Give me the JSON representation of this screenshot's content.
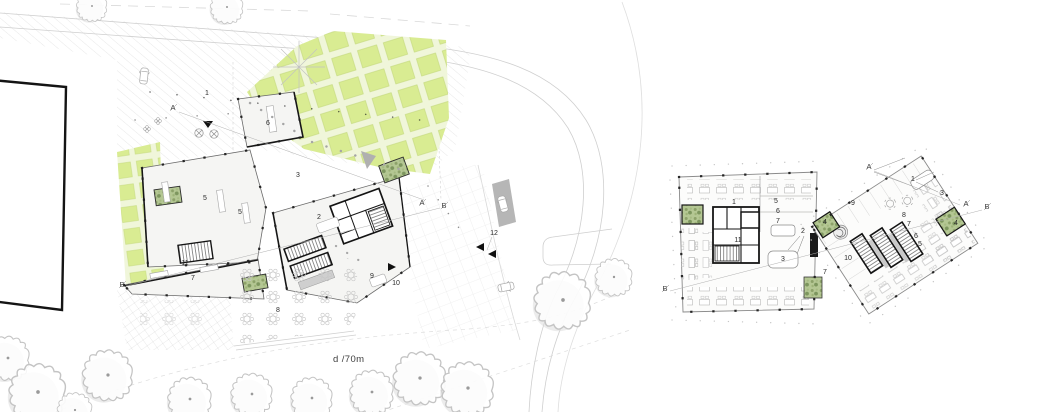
{
  "drawing_title": "architectural site and floor plan",
  "scale_label": "d /70m",
  "colors": {
    "orchard_green": "#d9ec92",
    "orchard_bg": "#f0f6da",
    "courtyard_green": "#b4c793",
    "wall_black": "#161616",
    "line_gray": "#9a9a9a",
    "fill_light": "#f5f5f3"
  },
  "site_plan": {
    "room_labels": [
      {
        "label": "1"
      },
      {
        "label": "6"
      },
      {
        "label": "3"
      },
      {
        "label": "5"
      },
      {
        "label": "5"
      },
      {
        "label": "2"
      },
      {
        "label": "11"
      },
      {
        "label": "7"
      },
      {
        "label": "9"
      },
      {
        "label": "10"
      },
      {
        "label": "8"
      },
      {
        "label": "12"
      }
    ],
    "section_markers": [
      {
        "label": "A"
      },
      {
        "label": "A"
      },
      {
        "label": "B"
      },
      {
        "label": "B"
      }
    ]
  },
  "floor_plan": {
    "left_block_labels": [
      {
        "label": "1"
      },
      {
        "label": "5"
      },
      {
        "label": "6"
      },
      {
        "label": "7"
      },
      {
        "label": "2"
      },
      {
        "label": "11"
      },
      {
        "label": "3"
      }
    ],
    "right_block_labels": [
      {
        "label": "9"
      },
      {
        "label": "1"
      },
      {
        "label": "3"
      },
      {
        "label": "8"
      },
      {
        "label": "7"
      },
      {
        "label": "6"
      },
      {
        "label": "5"
      },
      {
        "label": "4"
      },
      {
        "label": "4"
      },
      {
        "label": "10"
      },
      {
        "label": "7"
      }
    ],
    "section_markers": [
      {
        "label": "A"
      },
      {
        "label": "A"
      },
      {
        "label": "B"
      },
      {
        "label": "B"
      }
    ]
  }
}
